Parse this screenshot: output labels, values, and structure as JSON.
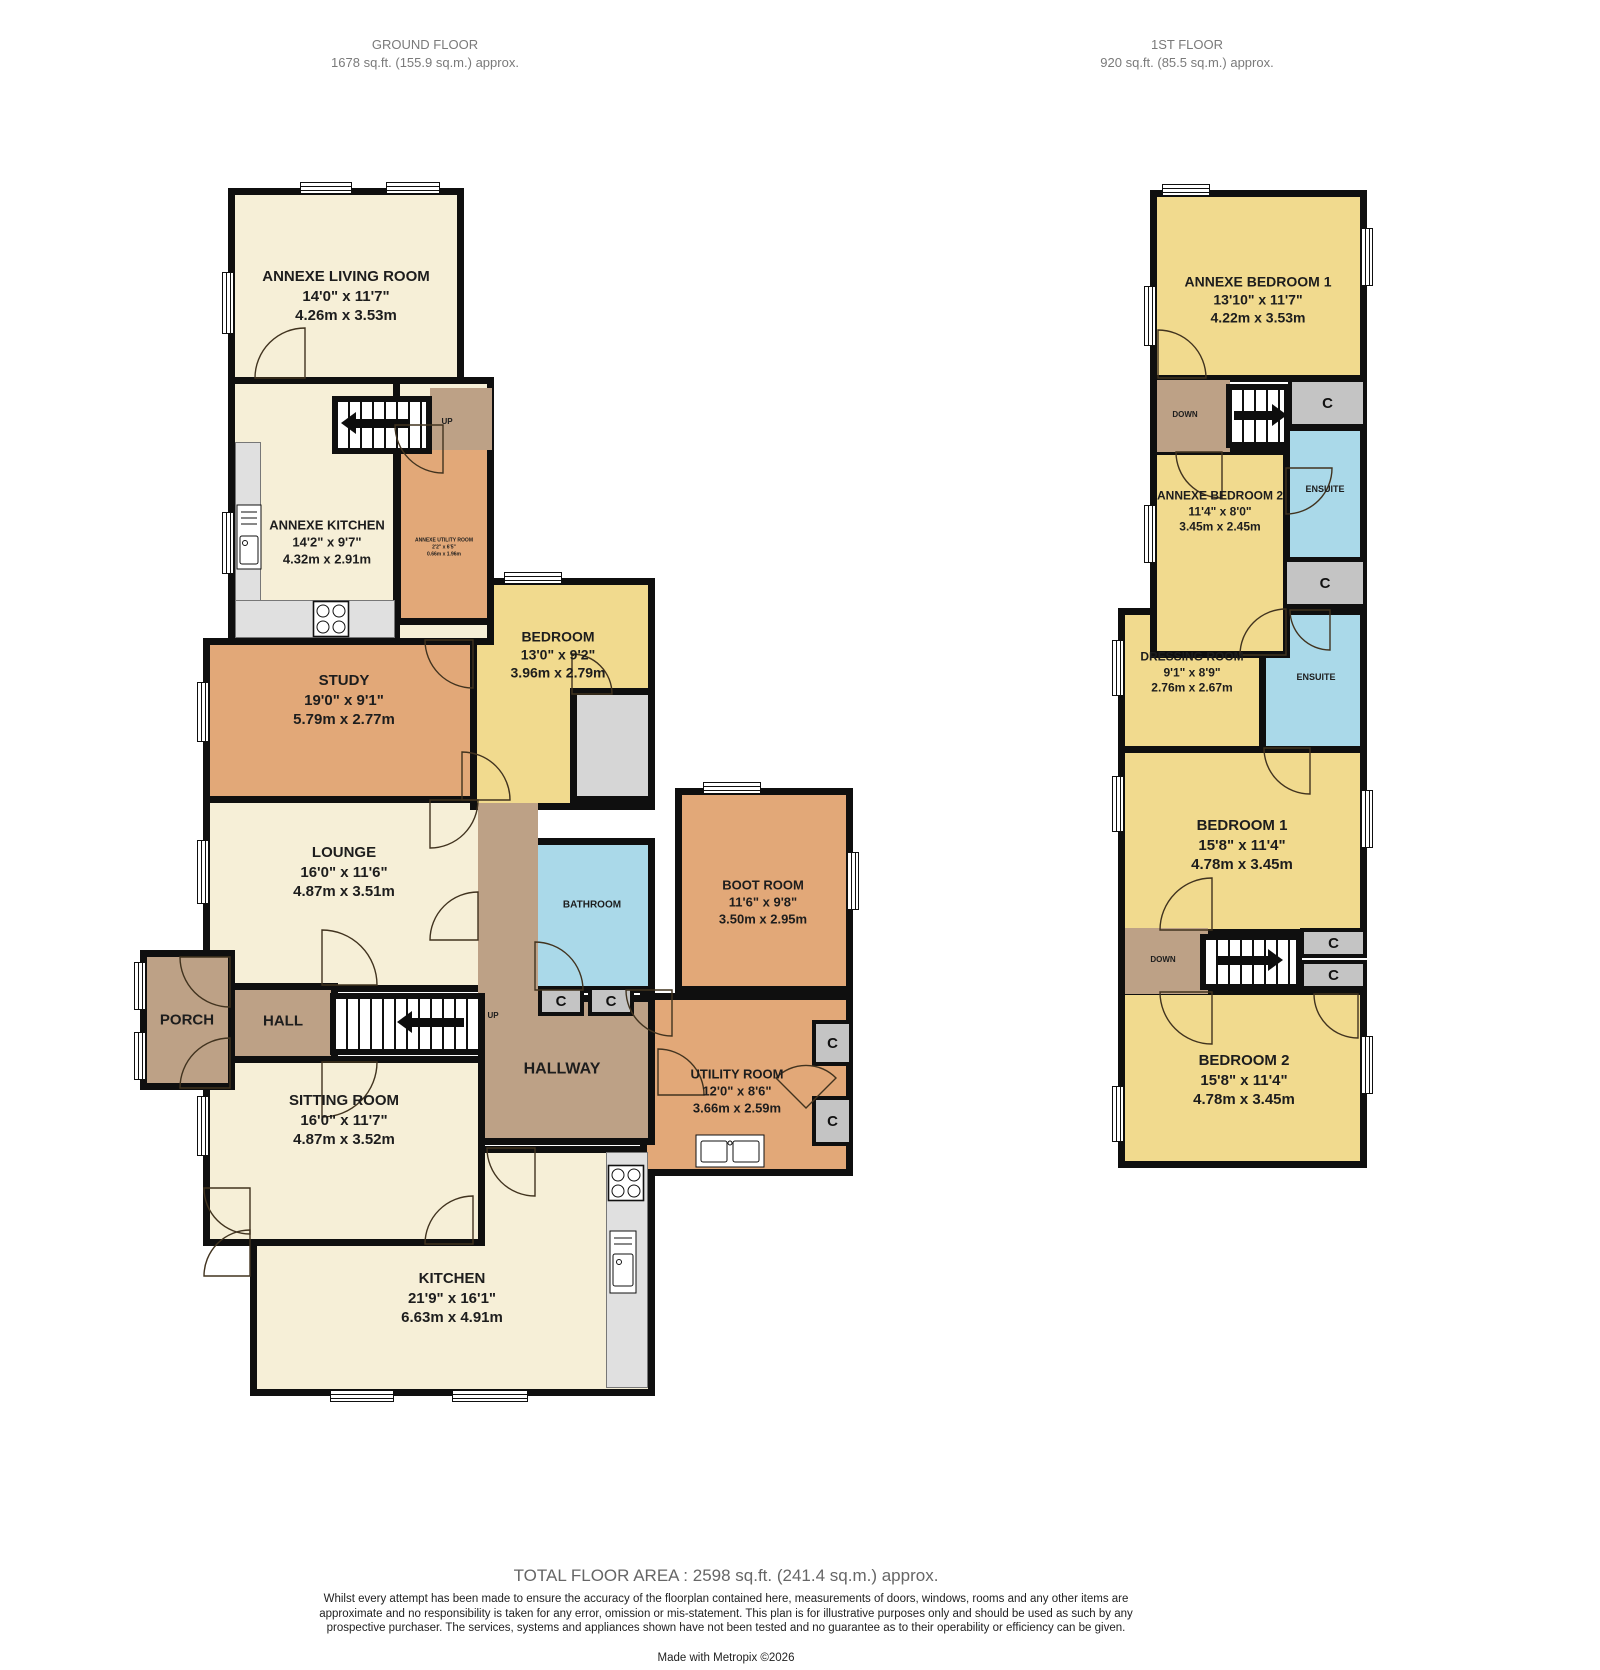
{
  "headers": {
    "ground": {
      "title": "GROUND FLOOR",
      "area": "1678 sq.ft. (155.9 sq.m.) approx."
    },
    "first": {
      "title": "1ST FLOOR",
      "area": "920 sq.ft. (85.5 sq.m.) approx."
    }
  },
  "labels": {
    "up": "UP",
    "down": "DOWN",
    "cupboard": "C"
  },
  "ground": {
    "annexe_living": {
      "name": "ANNEXE LIVING ROOM",
      "imperial": "14'0\" x 11'7\"",
      "metric": "4.26m x 3.53m"
    },
    "annexe_kitchen": {
      "name": "ANNEXE KITCHEN",
      "imperial": "14'2\" x 9'7\"",
      "metric": "4.32m x 2.91m"
    },
    "annexe_utility": {
      "name": "ANNEXE UTILITY ROOM",
      "imperial": "2'2\" x 6'5\"",
      "metric": "0.66m x 1.96m"
    },
    "study": {
      "name": "STUDY",
      "imperial": "19'0\" x 9'1\"",
      "metric": "5.79m x 2.77m"
    },
    "bedroom": {
      "name": "BEDROOM",
      "imperial": "13'0\" x 9'2\"",
      "metric": "3.96m x 2.79m"
    },
    "lounge": {
      "name": "LOUNGE",
      "imperial": "16'0\" x 11'6\"",
      "metric": "4.87m x 3.51m"
    },
    "bathroom": {
      "name": "BATHROOM"
    },
    "boot_room": {
      "name": "BOOT ROOM",
      "imperial": "11'6\" x 9'8\"",
      "metric": "3.50m x 2.95m"
    },
    "porch": {
      "name": "PORCH"
    },
    "hall": {
      "name": "HALL"
    },
    "hallway": {
      "name": "HALLWAY"
    },
    "utility": {
      "name": "UTILITY ROOM",
      "imperial": "12'0\" x 8'6\"",
      "metric": "3.66m x 2.59m"
    },
    "sitting": {
      "name": "SITTING ROOM",
      "imperial": "16'0\" x 11'7\"",
      "metric": "4.87m x 3.52m"
    },
    "kitchen": {
      "name": "KITCHEN",
      "imperial": "21'9\" x 16'1\"",
      "metric": "6.63m x 4.91m"
    }
  },
  "first": {
    "annexe_bedroom_1": {
      "name": "ANNEXE BEDROOM 1",
      "imperial": "13'10\" x 11'7\"",
      "metric": "4.22m x 3.53m"
    },
    "annexe_bedroom_2": {
      "name": "ANNEXE BEDROOM 2",
      "imperial": "11'4\" x 8'0\"",
      "metric": "3.45m x 2.45m"
    },
    "ensuite": {
      "name": "ENSUITE"
    },
    "dressing": {
      "name": "DRESSING ROOM",
      "imperial": "9'1\" x 8'9\"",
      "metric": "2.76m x 2.67m"
    },
    "bedroom_1": {
      "name": "BEDROOM 1",
      "imperial": "15'8\" x 11'4\"",
      "metric": "4.78m x 3.45m"
    },
    "bedroom_2": {
      "name": "BEDROOM 2",
      "imperial": "15'8\" x 11'4\"",
      "metric": "4.78m x 3.45m"
    }
  },
  "footer": {
    "total": "TOTAL FLOOR AREA : 2598 sq.ft. (241.4 sq.m.) approx.",
    "disclaimer": "Whilst every attempt has been made to ensure the accuracy of the floorplan contained here, measurements of doors, windows, rooms and any other items are approximate and no responsibility is taken for any error, omission or mis-statement. This plan is for illustrative purposes only and should be used as such by any prospective purchaser. The services, systems and appliances shown have not been tested and no guarantee as to their operability or efficiency can be given.",
    "credit": "Made with Metropix ©2026"
  },
  "colors": {
    "wall": "#0f0f0f",
    "cream": "#f6efd7",
    "yellow": "#f1da8e",
    "orange": "#e2a878",
    "blue": "#aad9e9",
    "brown": "#bda186",
    "counter": "#e0e0e0",
    "cupboard": "#c4c4c4"
  }
}
